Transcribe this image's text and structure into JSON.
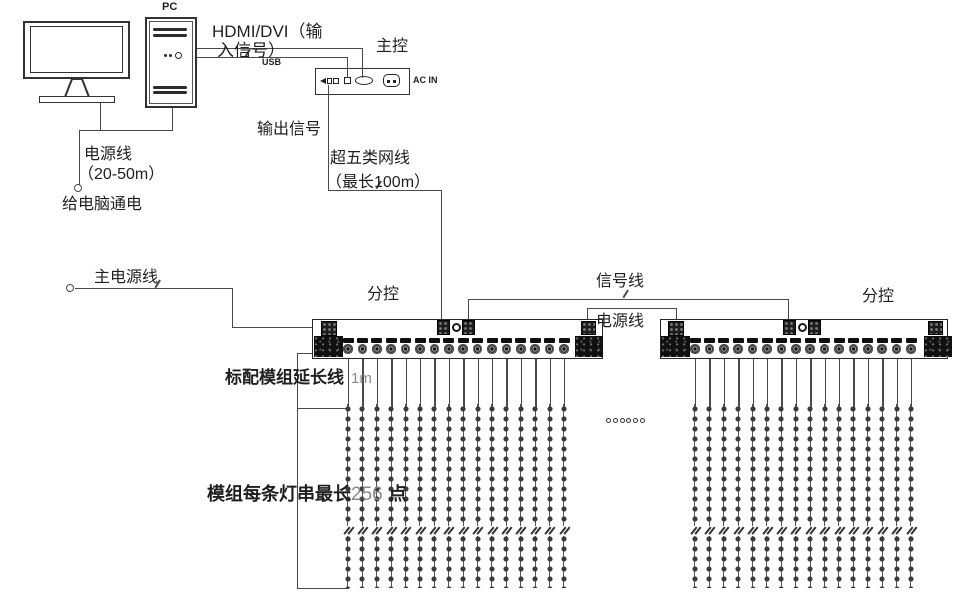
{
  "labels": {
    "pc": "PC",
    "hdmi_line1": "HDMI/DVI（输",
    "hdmi_line2": "入信号）",
    "usb": "USB",
    "main_controller": "主控",
    "ac_in": "AC IN",
    "pc_power_cable": "电源线",
    "pc_power_length": "（20-50m）",
    "pc_power_note": "给电脑通电",
    "output_signal": "输出信号",
    "cat5_cable": "超五类网线",
    "cat5_length": "（最长100m）",
    "main_power": "主电源线",
    "sub_controller_1": "分控",
    "sub_controller_2": "分控",
    "signal_wire": "信号线",
    "power_wire": "电源线",
    "extension_prefix": "标配模组延长线",
    "extension_value": "1m",
    "string_prefix": "模组每条灯串最长",
    "string_value": "256",
    "string_suffix": "点"
  },
  "figure": {
    "sub_controller_count": 2,
    "ports_per_sub_controller": 16,
    "led_strings_per_sub_controller": 16,
    "max_points_per_string": 256,
    "module_extension_length": "1m",
    "cat5_max_length": "100m",
    "pc_power_range": "20-50m",
    "ellipsis_dots": 6
  },
  "colors": {
    "line": "#4a4a4a",
    "text": "#1f1f1f",
    "muted": "#8a8a8a",
    "block": "#101010"
  }
}
